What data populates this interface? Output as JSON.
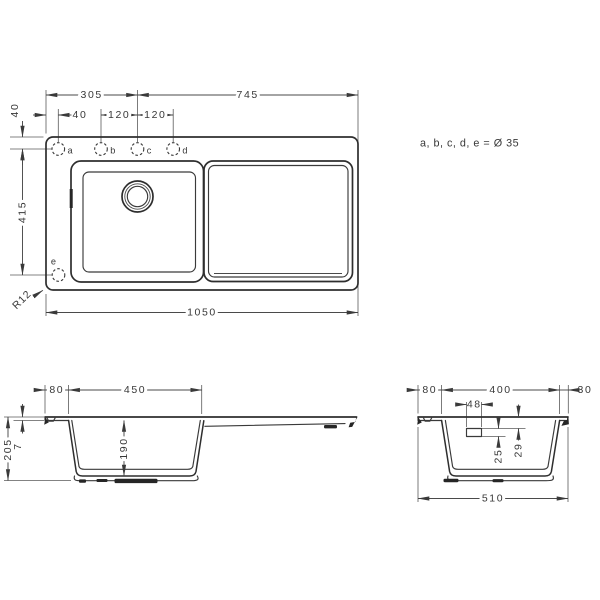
{
  "drawing_title": "sink-dimension-drawing",
  "note": "a, b, c, d, e = Ø 35",
  "plan": {
    "dim_305": "305",
    "dim_745": "745",
    "dim_40_hole_offset": "40",
    "dim_120_bc": "120",
    "dim_120_cd": "120",
    "dim_40_top_offset": "40",
    "dim_415": "415",
    "dim_1050": "1050",
    "corner_radius": "R12",
    "holes": [
      "a",
      "b",
      "c",
      "d",
      "e"
    ]
  },
  "side_section": {
    "dim_80": "80",
    "dim_450": "450",
    "dim_7": "7",
    "dim_190": "190",
    "dim_205": "205"
  },
  "cross_section": {
    "dim_80": "80",
    "dim_400": "400",
    "dim_30": "30",
    "dim_48": "48",
    "dim_25": "25",
    "dim_29": "29",
    "dim_510": "510"
  },
  "colors": {
    "background": "#ffffff",
    "profile_line": "#2e2e2e",
    "dimension_line": "#4a4a4a",
    "text": "#383838"
  }
}
